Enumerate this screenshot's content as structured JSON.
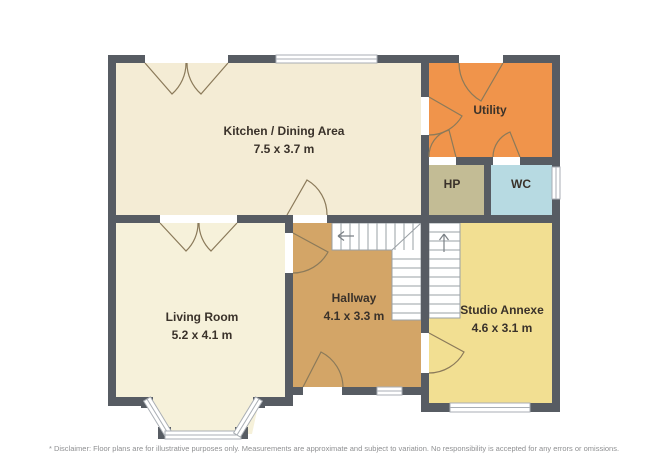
{
  "palette": {
    "wall": "#575c63",
    "door": "#8b7a5a",
    "window-frame": "#a9aeb4",
    "stair-line": "#9aa0a5",
    "arrow": "#7b8186",
    "label-text": "#3a322a",
    "disclaimer-text": "#8f9092"
  },
  "floorplan": {
    "rooms": [
      {
        "name": "Kitchen / Dining Area",
        "dims": "7.5 x 3.7 m",
        "color": "#f4ecd5"
      },
      {
        "name": "Utility",
        "color": "#f0944b"
      },
      {
        "name": "HP",
        "color": "#c3bc95"
      },
      {
        "name": "WC",
        "color": "#b7dae2"
      },
      {
        "name": "Living Room",
        "dims": "5.2 x 4.1 m",
        "color": "#f6f1da"
      },
      {
        "name": "Hallway",
        "dims": "4.1 x 3.3 m",
        "color": "#d3a567"
      },
      {
        "name": "Studio Annexe",
        "dims": "4.6 x 3.1 m",
        "color": "#f2df92"
      }
    ],
    "disclaimer": "* Disclaimer: Floor plans are for illustrative purposes only. Measurements are approximate and subject to variation. No responsibility is accepted for any errors or omissions."
  }
}
